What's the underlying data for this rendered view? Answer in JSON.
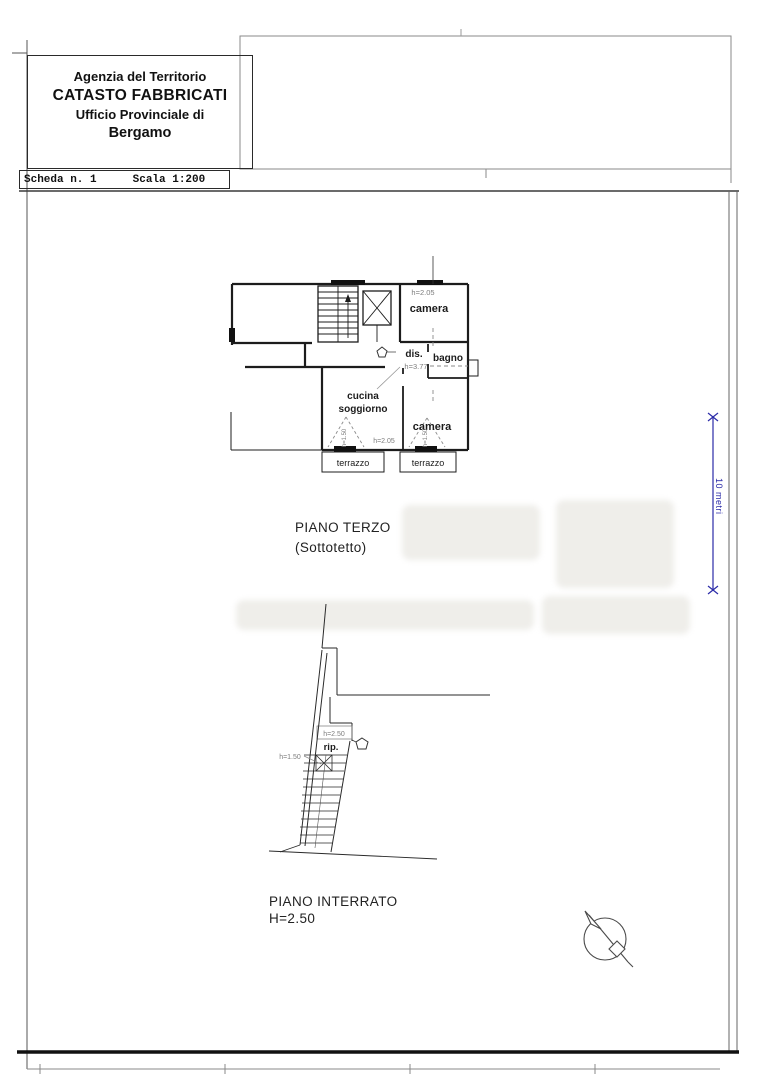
{
  "header": {
    "line1": "Agenzia del Territorio",
    "line2": "CATASTO FABBRICATI",
    "line3": "Ufficio Provinciale di",
    "line4": "Bergamo"
  },
  "scheda": {
    "number_label": "Scheda n. 1",
    "scale_label": "Scala 1:200"
  },
  "dimension": {
    "label": "10 metri"
  },
  "piano_terzo": {
    "title": "PIANO TERZO",
    "subtitle": "(Sottotetto)",
    "rooms": {
      "camera_top": "camera",
      "disimpegno": "dis.",
      "bagno": "bagno",
      "cucina_line1": "cucina",
      "cucina_line2": "soggiorno",
      "camera_bottom": "camera",
      "terrazzo_left": "terrazzo",
      "terrazzo_right": "terrazzo"
    },
    "heights": {
      "camera_top": "h=2.05",
      "colmo": "h=3.77",
      "gronda": "h=2.05",
      "falda_left": "h=1.50",
      "falda_right": "h=1.50"
    }
  },
  "piano_interrato": {
    "title": "PIANO INTERRATO",
    "height_label": "H=2.50",
    "rooms": {
      "ripostiglio": "rip."
    },
    "heights": {
      "ripostiglio": "h=2.50",
      "under_stairs": "h=1.50"
    }
  },
  "colors": {
    "line": "#1c1c1c",
    "annotation": "#7d7d7d",
    "dimension_blue": "#2b2ba8",
    "watermark": "#efeeea"
  }
}
